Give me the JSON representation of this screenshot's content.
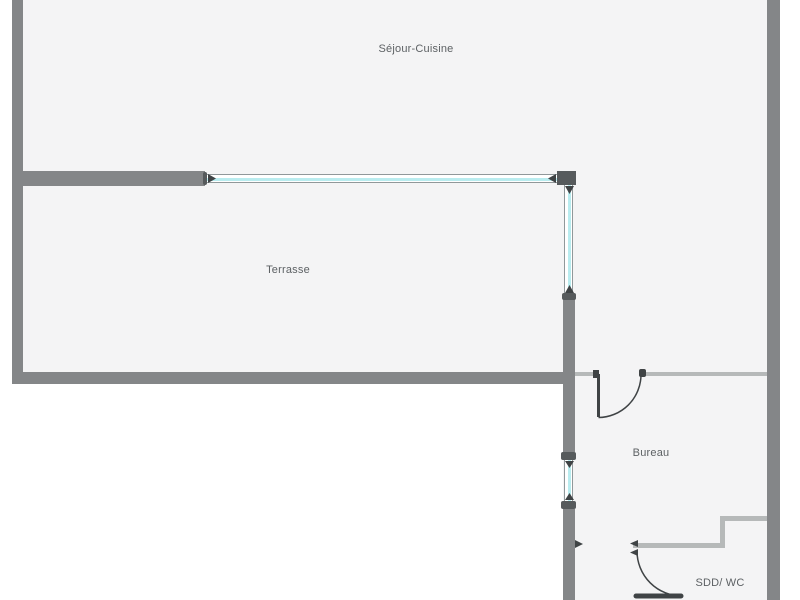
{
  "plan": {
    "type": "floor-plan",
    "rooms": {
      "sejour": {
        "label": "Séjour-Cuisine"
      },
      "terrasse": {
        "label": "Terrasse"
      },
      "bureau": {
        "label": "Bureau"
      },
      "sdd_wc": {
        "label": "SDD/ WC"
      }
    },
    "colors": {
      "outside": "#ffffff",
      "floor": "#f4f4f5",
      "wall": "#848688",
      "wall_dark": "#565a5c",
      "wall_thin": "#b6b9b9",
      "window_glass": "#b9ecef",
      "window_frame": "#90989a",
      "door": "#3f4345",
      "text": "#5d6164"
    }
  }
}
